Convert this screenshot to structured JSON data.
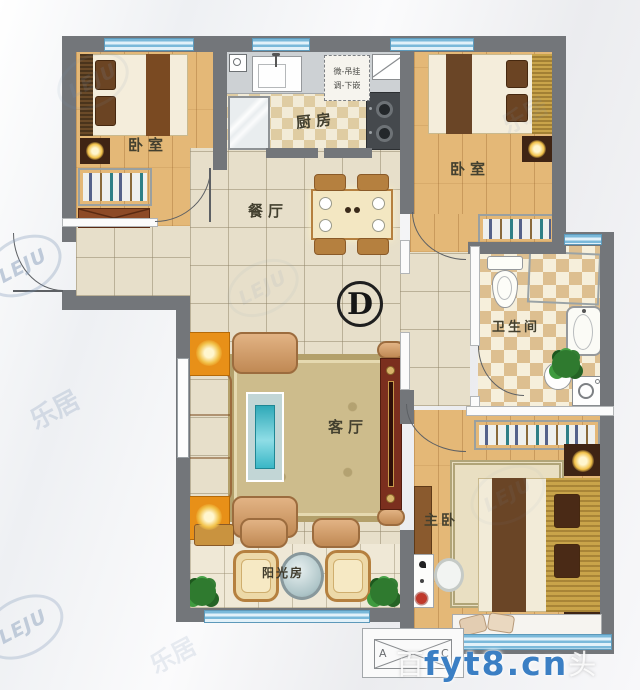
{
  "unit": {
    "type_label": "D"
  },
  "rooms": {
    "bedroom_top_left": {
      "label": "卧室"
    },
    "kitchen": {
      "label": "厨房"
    },
    "bedroom_top_right": {
      "label": "卧室"
    },
    "dining": {
      "label": "餐厅"
    },
    "living": {
      "label": "客厅"
    },
    "bathroom": {
      "label": "卫生间"
    },
    "master_bedroom": {
      "label": "主卧"
    },
    "sunroom": {
      "label": "阳光房"
    }
  },
  "annotations": {
    "kitchen_note_line1": "微-吊挂",
    "kitchen_note_line2": "调-下嵌",
    "ac_unit_left": "A",
    "ac_unit_right": "C"
  },
  "watermarks": {
    "logo": "LEJU",
    "logo_cn": "乐居",
    "site": "fyt8.cn",
    "site_prefix": "百",
    "site_suffix": "头"
  },
  "colors": {
    "wall": "#73767a",
    "wood_floor": "#e4b877",
    "tile_floor": "#e7dfca",
    "window_blue": "#7ab9da",
    "accent_orange": "#e89018",
    "tv_cabinet": "#7b2f1e",
    "watermark_blue": "#3b7fc4"
  }
}
